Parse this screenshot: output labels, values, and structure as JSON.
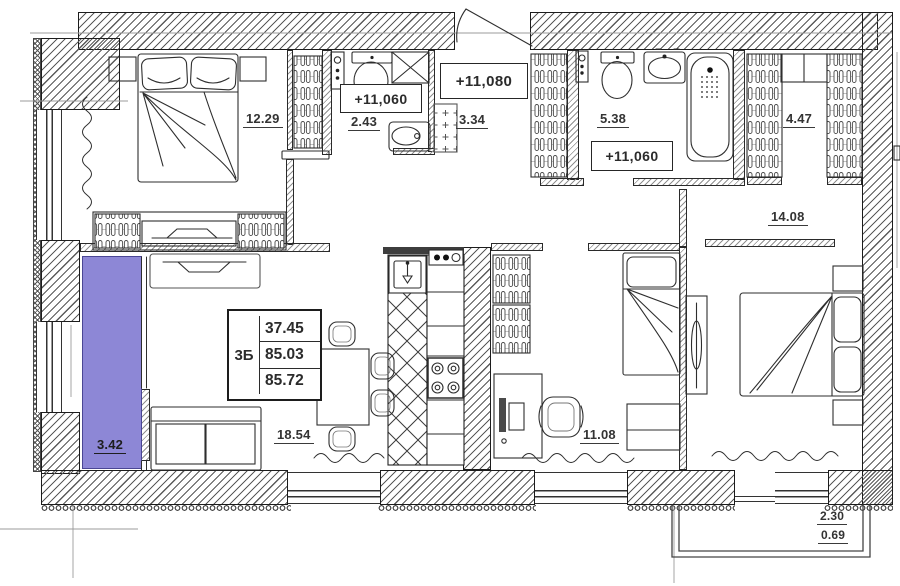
{
  "plan": {
    "title": "apartment-floor-plan",
    "info_table": {
      "type": "3Б",
      "values": [
        "37.45",
        "85.03",
        "85.72"
      ]
    },
    "rooms": {
      "bedroom1": "12.29",
      "wc": "2.43",
      "hallway": "3.34",
      "bathroom": "5.38",
      "closet": "4.47",
      "bedroom2": "14.08",
      "living_kitchen": "18.54",
      "kids_room": "11.08",
      "loggia": "3.42"
    },
    "elevations": {
      "wc": "+11,060",
      "hallway": "+11,080",
      "bathroom": "+11,060"
    },
    "balcony": {
      "width": "2.30",
      "depth": "0.69"
    },
    "colors": {
      "loggia_highlight": "#8d87d6",
      "wall_line": "#2e2e2e"
    }
  }
}
